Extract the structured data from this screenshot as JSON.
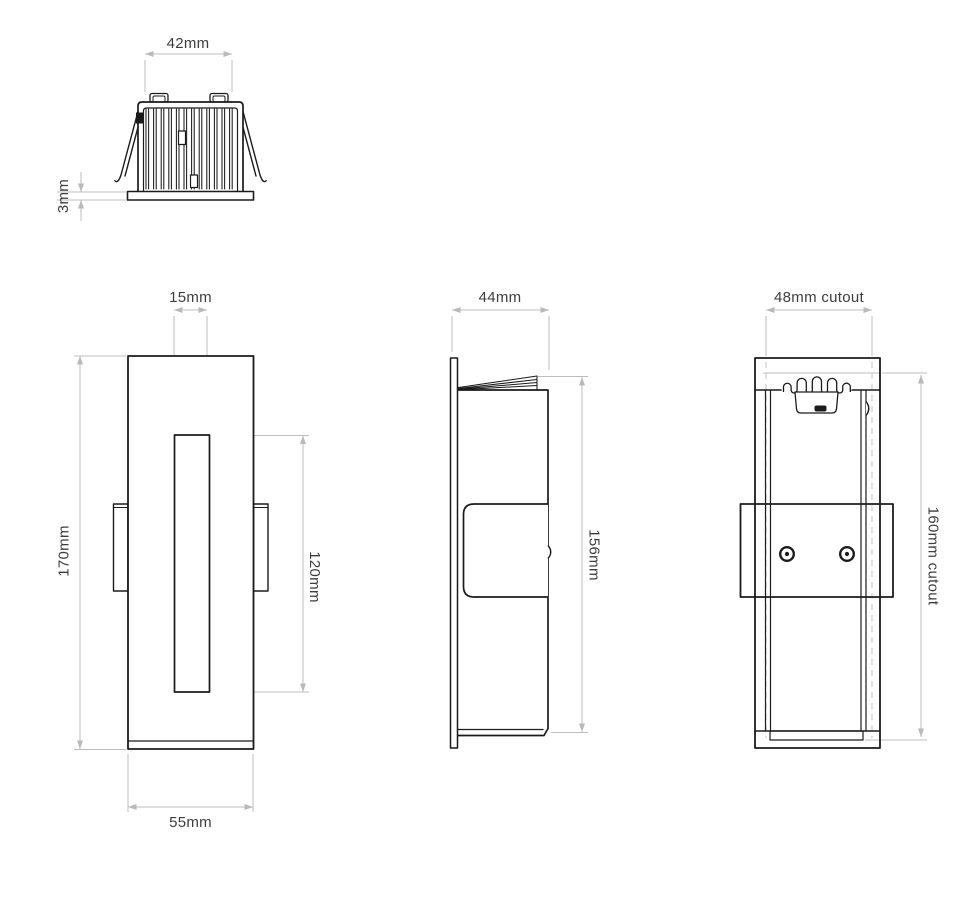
{
  "drawing": {
    "type": "technical-dimension-drawing",
    "views": {
      "top_view": {
        "dimensions": {
          "width": "42mm",
          "plate_thickness": "3mm"
        }
      },
      "front_view": {
        "dimensions": {
          "slot_width": "15mm",
          "height": "170mm",
          "slot_height": "120mm",
          "width": "55mm"
        }
      },
      "side_view": {
        "dimensions": {
          "depth": "44mm",
          "height": "156mm"
        }
      },
      "rear_view": {
        "dimensions": {
          "cutout_width": "48mm cutout",
          "cutout_height": "160mm cutout"
        }
      }
    },
    "colors": {
      "object_line": "#1b1b1b",
      "dimension_line": "#bdbdbd",
      "dimension_text": "#3d3d3d",
      "background": "#ffffff"
    }
  }
}
